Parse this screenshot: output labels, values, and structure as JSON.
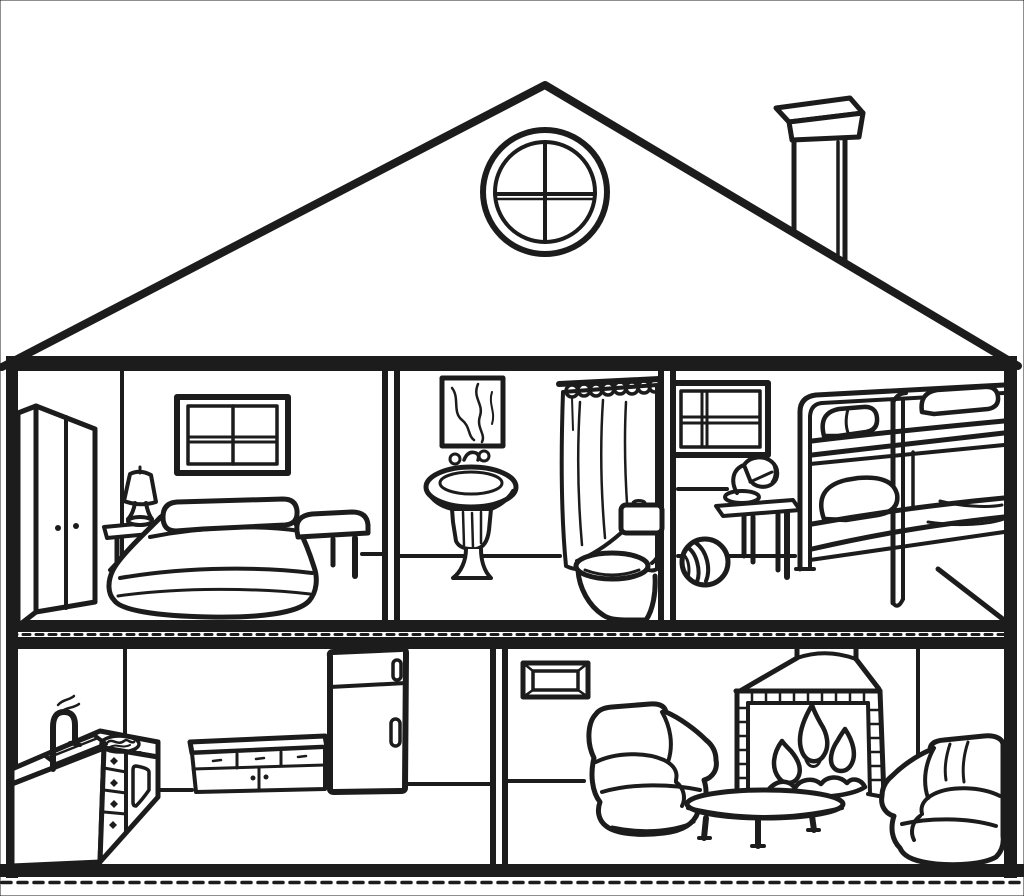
{
  "palette": {
    "ink": "#1c1c1c",
    "paper": "#ffffff"
  },
  "scene": {
    "type": "house-cutaway-line-drawing",
    "style": "black-and-white coloring-page illustration, no text",
    "exterior": [
      "gable-roof",
      "round-attic-window-with-cross-mullions",
      "chimney-with-cap",
      "outer-walls",
      "floor-slabs"
    ],
    "floors": [
      {
        "name": "upper",
        "rooms": [
          {
            "name": "bedroom",
            "items": [
              "wardrobe",
              "four-pane-window",
              "bedside-lamp",
              "nightstand",
              "double-bed-with-pillow",
              "bench"
            ]
          },
          {
            "name": "bathroom",
            "items": [
              "wall-picture",
              "pedestal-sink-with-towel",
              "faucet-taps",
              "shower-curtain-with-rings",
              "toilet"
            ]
          },
          {
            "name": "kids-bedroom",
            "items": [
              "window",
              "desk-lamp",
              "play-table",
              "beach-ball",
              "bunk-bed"
            ]
          }
        ]
      },
      {
        "name": "lower",
        "rooms": [
          {
            "name": "kitchen",
            "items": [
              "sink-with-faucet",
              "counter-with-drawers-and-oven",
              "stove-burner",
              "sideboard-cabinet",
              "refrigerator"
            ]
          },
          {
            "name": "living-room",
            "items": [
              "wall-vent-frame",
              "fireplace-with-fire",
              "armchair-left",
              "armchair-right",
              "oval-coffee-table"
            ]
          }
        ]
      }
    ]
  }
}
